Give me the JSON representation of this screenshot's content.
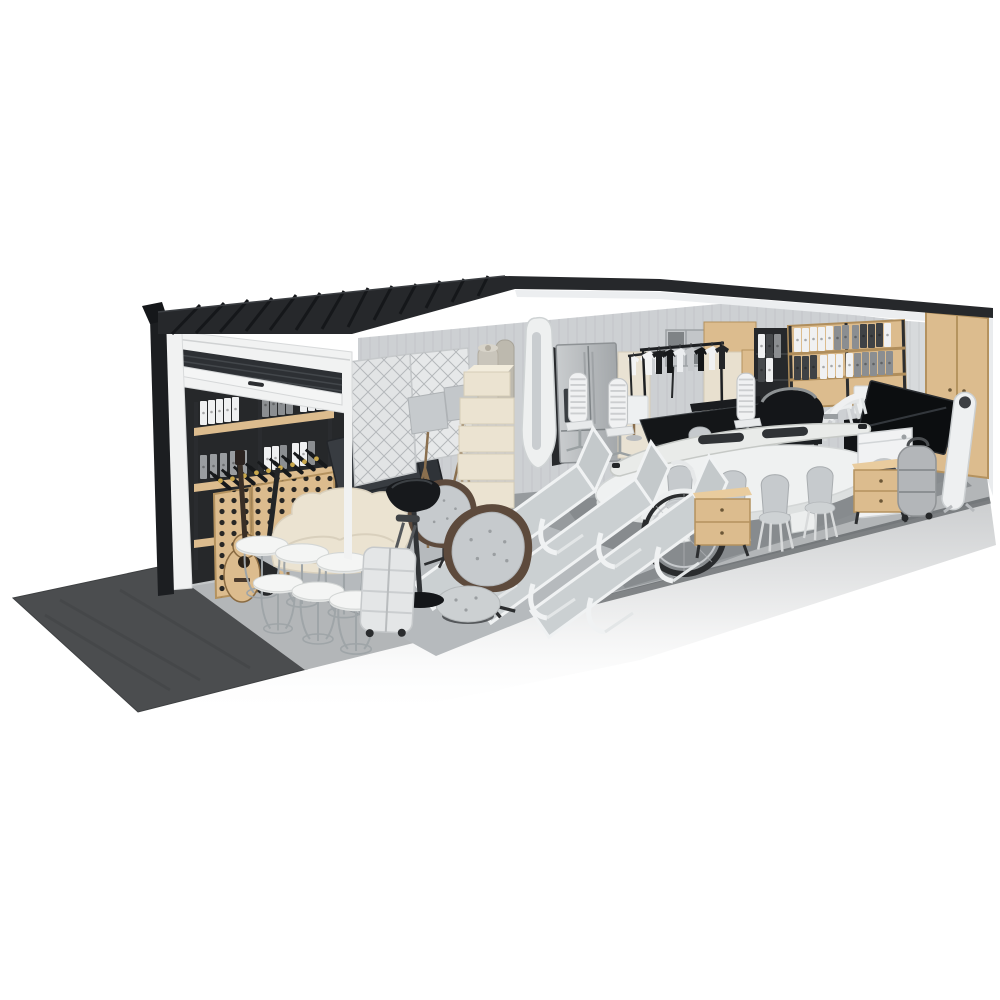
{
  "scene": {
    "description": "3D cutaway render of a self-storage garage unit with a partially open roller door, packed with household furniture and items, viewed from the front-left on a white background",
    "background": "#ffffff"
  },
  "palette": {
    "background": "#ffffff",
    "roof": "#26282b",
    "roofRib": "#15171a",
    "trim": "#1c1e21",
    "wall": "#cdd0d3",
    "wallStripe": "#bec1c4",
    "wallRight": "#d7dadc",
    "ceiling": "#eceef0",
    "exterior": "#eaecee",
    "doorFrame": "#f1f2f2",
    "doorSlat": "#2d3034",
    "opening": "#26282a",
    "floor": "#94989b",
    "pad": "#b3b6b8",
    "slabEdge": "#606467",
    "asphalt": "#4b4d4f",
    "rugLight": "#b6babd",
    "rugDark": "#84888b",
    "wood": "#dcbc8e",
    "woodDeep": "#b4925f",
    "cream": "#ebe3d1",
    "black": "#17191c",
    "steel": "#b4b8bb",
    "white": "#f2f3f4",
    "grayFabric": "#c6cacd",
    "brown": "#5d4a3c",
    "chrome": "#9fa5a8",
    "gold": "#c9a84c",
    "tire": "#2a2c2e",
    "shadow": "#989c9f"
  },
  "items": [
    {
      "id": "roller-door",
      "label": "Roller garage door, partially open"
    },
    {
      "id": "shelf-binders-left",
      "label": "Black metal shelving with white and gray binders"
    },
    {
      "id": "wine-rack",
      "label": "Wooden wine rack full of bottles"
    },
    {
      "id": "guitars",
      "label": "Acoustic guitar and dark guitar"
    },
    {
      "id": "tv-screens-left",
      "label": "Flat screen TVs leaning on wall"
    },
    {
      "id": "quilted-panels",
      "label": "Quilted furniture pads against wall"
    },
    {
      "id": "floor-lamps",
      "label": "Tripod floor lamps with gray shades"
    },
    {
      "id": "storage-boxes",
      "label": "Stack of cream storage boxes"
    },
    {
      "id": "rolled-rugs",
      "label": "Rolled rugs standing upright"
    },
    {
      "id": "paddleboard",
      "label": "White paddleboard with dark board bag"
    },
    {
      "id": "refrigerator",
      "label": "Stainless steel refrigerator"
    },
    {
      "id": "cream-cabinet",
      "label": "Cream tall cabinet"
    },
    {
      "id": "clothes-racks",
      "label": "Garment racks with black and white shirts"
    },
    {
      "id": "cube-shelf",
      "label": "Gray cube storage shelf"
    },
    {
      "id": "oak-cabinets",
      "label": "Light oak storage cabinets"
    },
    {
      "id": "digital-piano",
      "label": "Black digital piano"
    },
    {
      "id": "bbq-grill",
      "label": "Black barbecue grill"
    },
    {
      "id": "canoe",
      "label": "White canoe resting on dining table"
    },
    {
      "id": "dining-table",
      "label": "White oval dining table"
    },
    {
      "id": "dining-chairs",
      "label": "Gray molded dining chairs"
    },
    {
      "id": "office-chairs",
      "label": "White ribbed office chairs"
    },
    {
      "id": "sun-loungers",
      "label": "Three white sun loungers"
    },
    {
      "id": "bicycle",
      "label": "Bicycle behind loungers"
    },
    {
      "id": "nightstands",
      "label": "Oak two-drawer nightstands"
    },
    {
      "id": "sofa",
      "label": "Cream two-seat sofa"
    },
    {
      "id": "nesting-tables",
      "label": "White round nesting side tables"
    },
    {
      "id": "suitcase",
      "label": "Hard-shell trolley suitcase"
    },
    {
      "id": "bar-stool",
      "label": "Black pedestal stool"
    },
    {
      "id": "armchairs",
      "label": "Tufted swivel armchairs with ottoman"
    },
    {
      "id": "shelf-binders-right",
      "label": "Oak shelf with binder archive"
    },
    {
      "id": "stacked-chairs",
      "label": "Stacked white chairs"
    },
    {
      "id": "washing-machine",
      "label": "White washing machine"
    },
    {
      "id": "tv-right",
      "label": "Large TV leaning on black console"
    },
    {
      "id": "wardrobe",
      "label": "Tall oak wardrobe"
    },
    {
      "id": "ironing-board",
      "label": "White ironing board"
    },
    {
      "id": "duffel",
      "label": "Gray wheeled duffel bag"
    },
    {
      "id": "table-lamps",
      "label": "White drum table lamps"
    },
    {
      "id": "rug-left",
      "label": "Light gray area rug"
    },
    {
      "id": "rug-right",
      "label": "Dark gray area rug"
    },
    {
      "id": "asphalt-ramp",
      "label": "Dark asphalt entry mat"
    },
    {
      "id": "concrete-floor",
      "label": "Polished concrete floor and apron"
    }
  ]
}
